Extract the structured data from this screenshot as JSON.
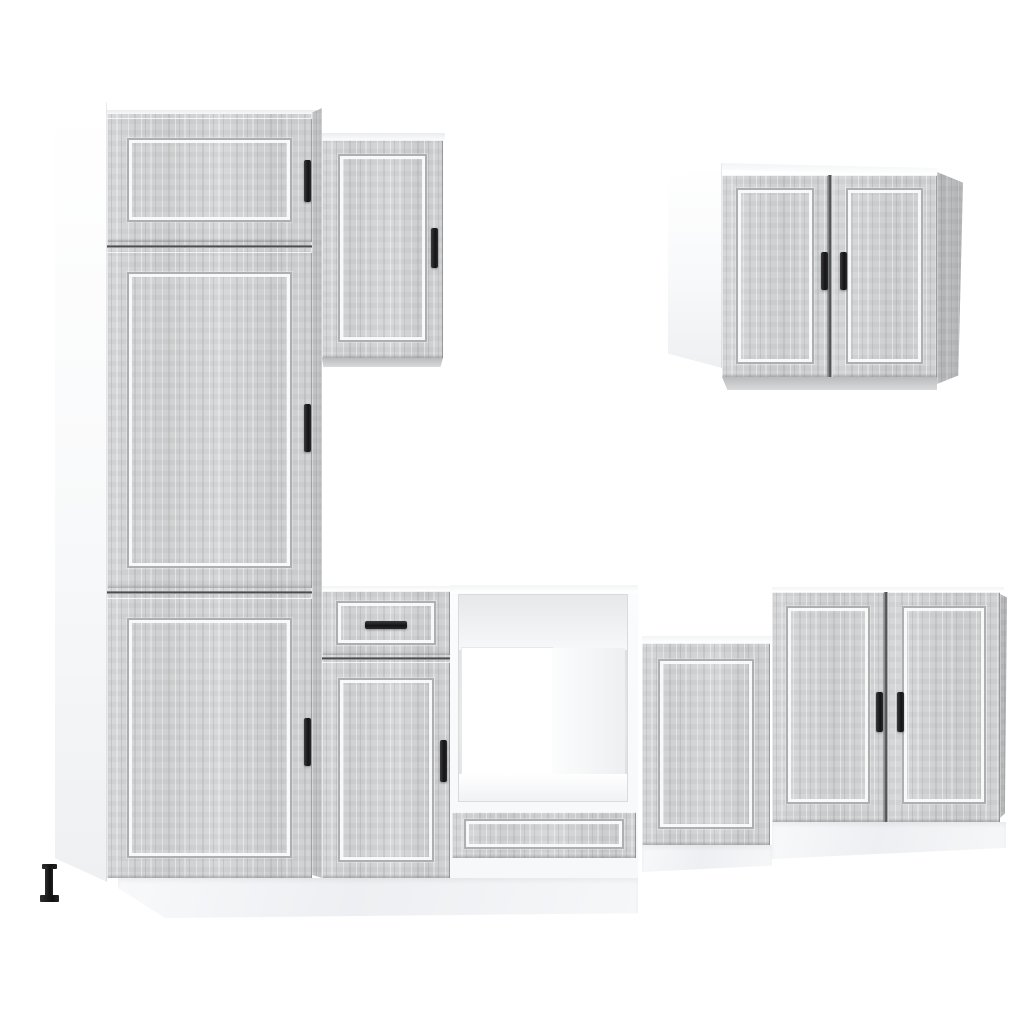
{
  "scene": {
    "description": "7-piece kitchen cabinet furniture set with grey sonoma wood-effect shaker fronts, white carcasses, black bar handles and white kickboard plinths, photographed on a plain white background",
    "material": "grey sonoma engineered wood",
    "background": "#ffffff"
  },
  "palette": {
    "wood_base": "#d2d3d5",
    "wood_streak_dark": "#8f9193",
    "wood_streak_light": "#f4f4f5",
    "carcass_white": "#ffffff",
    "carcass_shadow": "#eef0f2",
    "groove_dark": "rgba(122,125,127,0.6)",
    "groove_light": "rgba(251,251,252,0.95)",
    "gap_line": "#3a3c3e",
    "handle_black": "#141416",
    "foot_black": "#0f0f10",
    "plinth_tint": "#f2f3f5"
  },
  "units": [
    {
      "id": "tall-pantry-cabinet",
      "position": "far-left",
      "doors": 3,
      "drawers": 0,
      "handles": 3,
      "handle_style": "vertical black bar",
      "notes": "white left side panel, black adjustable front foot"
    },
    {
      "id": "wall-cabinet-single-door",
      "position": "upper-left-of-center",
      "doors": 1,
      "drawers": 0,
      "handles": 1,
      "handle_style": "vertical black bar"
    },
    {
      "id": "base-cabinet-drawer-door",
      "position": "lower-left-of-center",
      "doors": 1,
      "drawers": 1,
      "handles": 2,
      "handle_style": "one horizontal, one vertical black bar"
    },
    {
      "id": "oven-housing-cabinet",
      "position": "lower-center",
      "doors": 0,
      "drawers": 1,
      "handles": 0,
      "notes": "open appliance cavity with white interior and handleless bottom drawer front"
    },
    {
      "id": "base-cabinet-single-door-low",
      "position": "lower-right-of-center",
      "doors": 1,
      "drawers": 0,
      "handles": 0
    },
    {
      "id": "base-cabinet-double-door",
      "position": "lower-right",
      "doors": 2,
      "drawers": 0,
      "handles": 2,
      "handle_style": "vertical black bars at center stile"
    },
    {
      "id": "wall-cabinet-double-door",
      "position": "upper-right",
      "doors": 2,
      "drawers": 0,
      "handles": 2,
      "handle_style": "vertical black bars at center stile",
      "notes": "white left side panel, shaded right side panel"
    }
  ]
}
